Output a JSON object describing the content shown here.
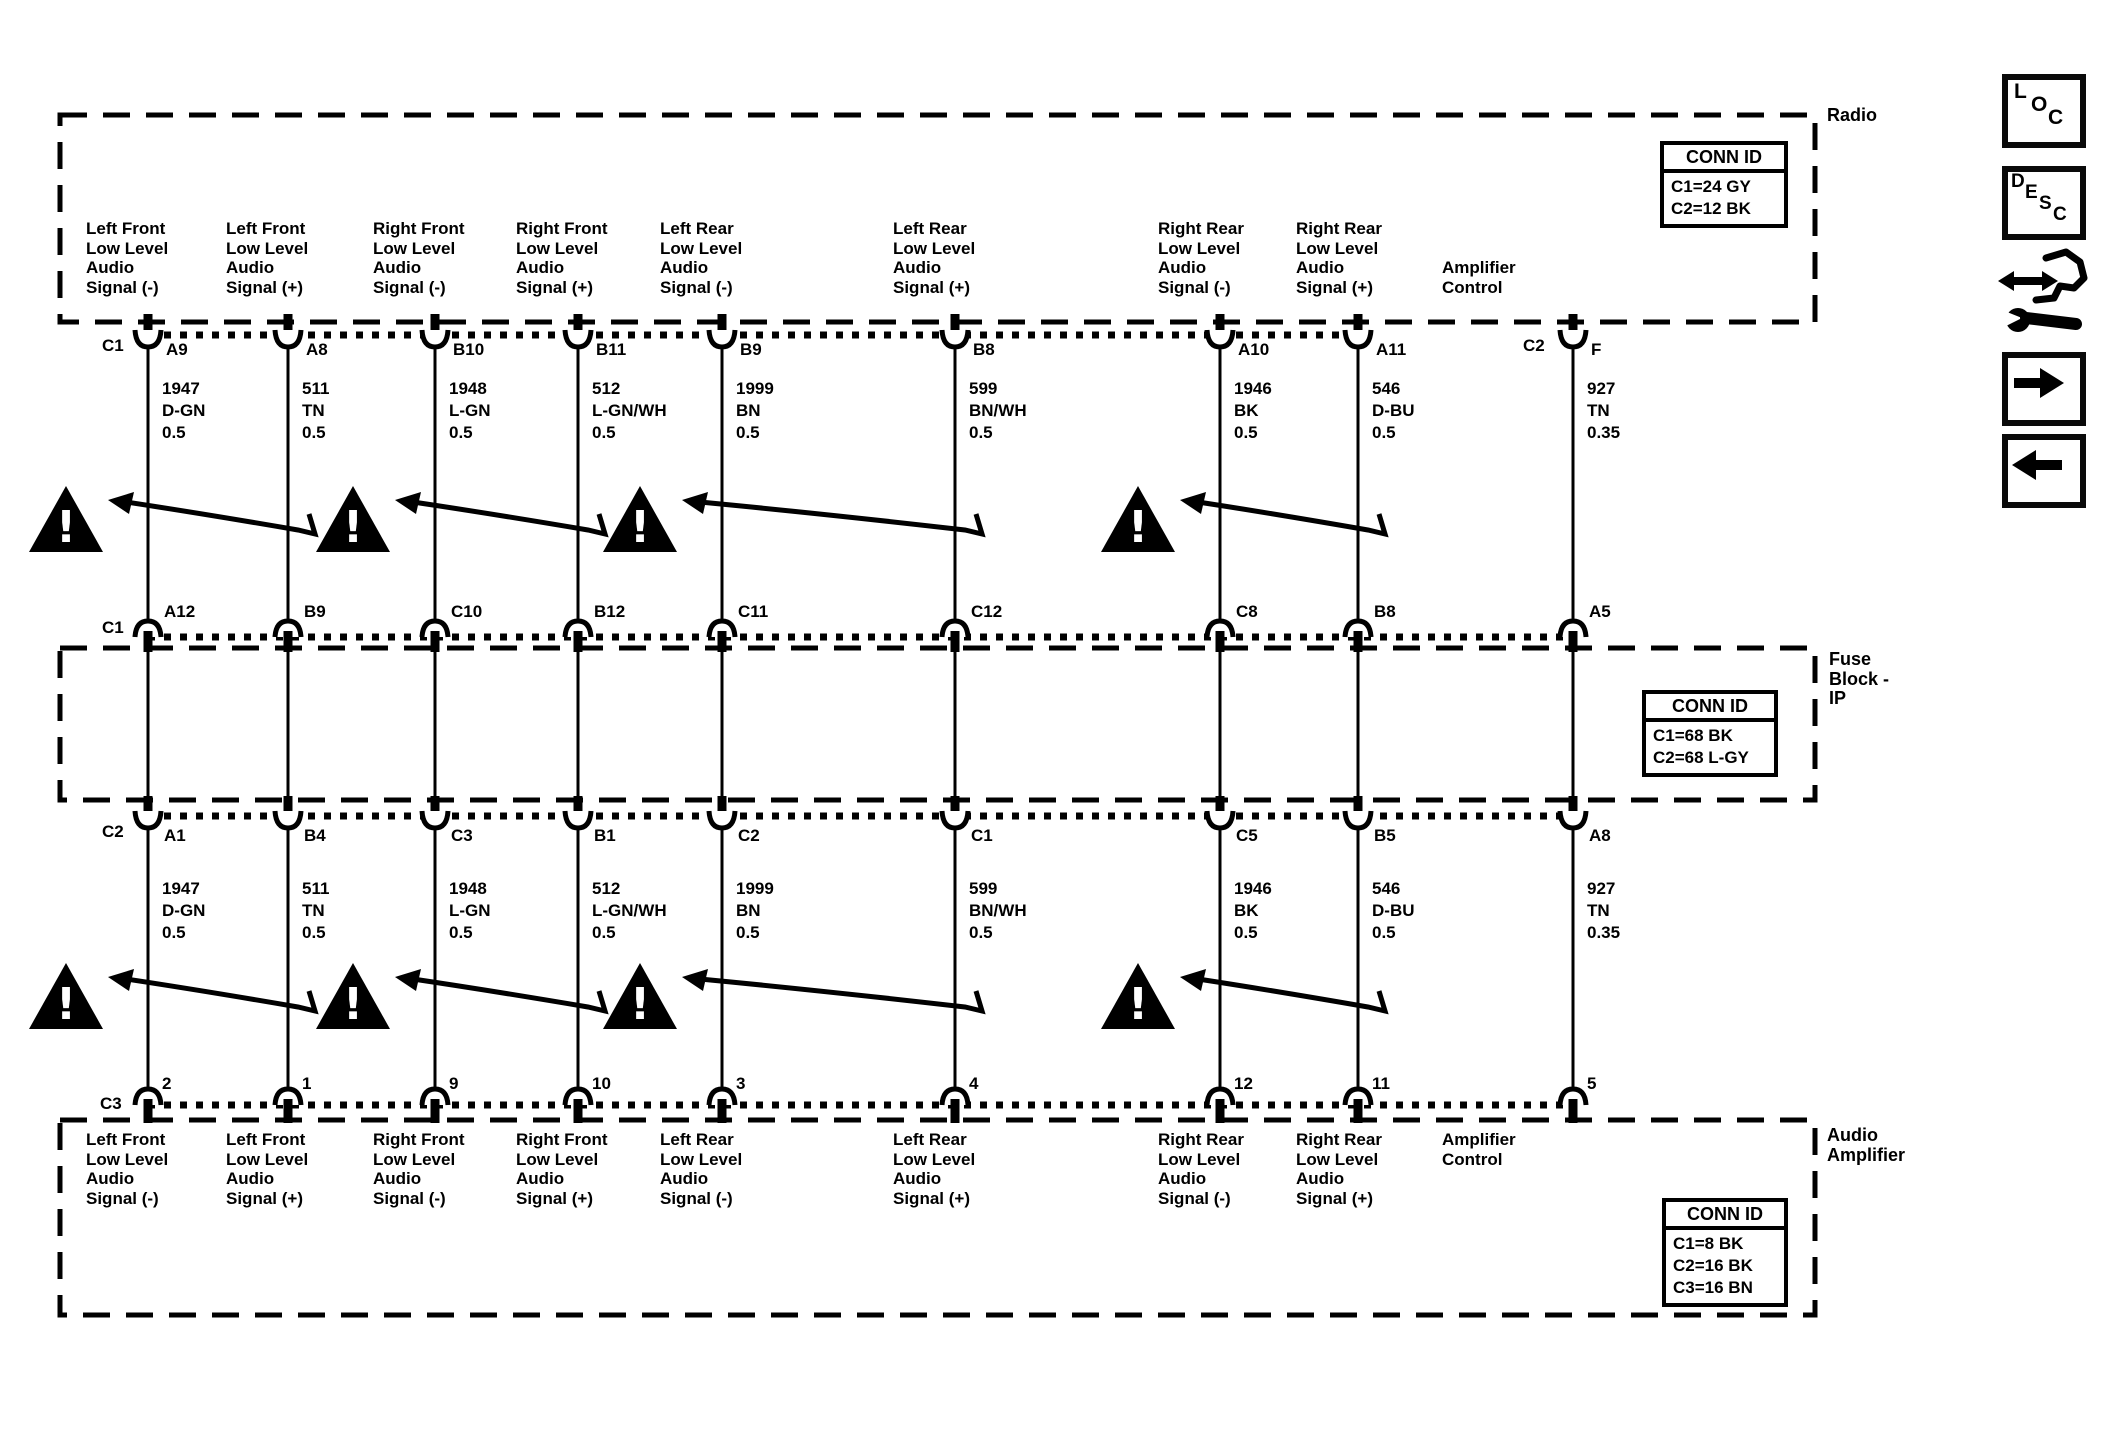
{
  "diagram": {
    "boxes": {
      "radio": {
        "title": "Radio",
        "conn_id": {
          "header": "CONN ID",
          "rows": [
            "C1=24 GY",
            "C2=12 BK"
          ]
        }
      },
      "fuse_block": {
        "title_lines": [
          "Fuse",
          "Block -",
          "IP"
        ],
        "conn_id": {
          "header": "CONN ID",
          "rows": [
            "C1=68 BK",
            "C2=68 L-GY"
          ]
        }
      },
      "audio_amplifier": {
        "title_lines": [
          "Audio",
          "Amplifier"
        ],
        "conn_id": {
          "header": "CONN ID",
          "rows": [
            "C1=8 BK",
            "C2=16 BK",
            "C3=16 BN"
          ]
        }
      }
    },
    "connector_designators": {
      "radio_c1": "C1",
      "radio_c2": "C2",
      "fuse_top": "C1",
      "fuse_bottom": "C2",
      "amp": "C3"
    },
    "columns": [
      {
        "signal": [
          "Left Front",
          "Low Level",
          "Audio",
          "Signal (-)"
        ],
        "radio_pin": "A9",
        "circuit": "1947",
        "color": "D-GN",
        "gauge": "0.5",
        "fuse_top_pin": "A12",
        "fuse_bottom_pin": "A1",
        "amp_pin": "2"
      },
      {
        "signal": [
          "Left Front",
          "Low Level",
          "Audio",
          "Signal (+)"
        ],
        "radio_pin": "A8",
        "circuit": "511",
        "color": "TN",
        "gauge": "0.5",
        "fuse_top_pin": "B9",
        "fuse_bottom_pin": "B4",
        "amp_pin": "1"
      },
      {
        "signal": [
          "Right Front",
          "Low Level",
          "Audio",
          "Signal (-)"
        ],
        "radio_pin": "B10",
        "circuit": "1948",
        "color": "L-GN",
        "gauge": "0.5",
        "fuse_top_pin": "C10",
        "fuse_bottom_pin": "C3",
        "amp_pin": "9"
      },
      {
        "signal": [
          "Right Front",
          "Low Level",
          "Audio",
          "Signal (+)"
        ],
        "radio_pin": "B11",
        "circuit": "512",
        "color": "L-GN/WH",
        "gauge": "0.5",
        "fuse_top_pin": "B12",
        "fuse_bottom_pin": "B1",
        "amp_pin": "10"
      },
      {
        "signal": [
          "Left Rear",
          "Low Level",
          "Audio",
          "Signal (-)"
        ],
        "radio_pin": "B9",
        "circuit": "1999",
        "color": "BN",
        "gauge": "0.5",
        "fuse_top_pin": "C11",
        "fuse_bottom_pin": "C2",
        "amp_pin": "3"
      },
      {
        "signal": [
          "Left Rear",
          "Low Level",
          "Audio",
          "Signal (+)"
        ],
        "radio_pin": "B8",
        "circuit": "599",
        "color": "BN/WH",
        "gauge": "0.5",
        "fuse_top_pin": "C12",
        "fuse_bottom_pin": "C1",
        "amp_pin": "4"
      },
      {
        "signal": [
          "Right Rear",
          "Low Level",
          "Audio",
          "Signal (-)"
        ],
        "radio_pin": "A10",
        "circuit": "1946",
        "color": "BK",
        "gauge": "0.5",
        "fuse_top_pin": "C8",
        "fuse_bottom_pin": "C5",
        "amp_pin": "12"
      },
      {
        "signal": [
          "Right Rear",
          "Low Level",
          "Audio",
          "Signal (+)"
        ],
        "radio_pin": "A11",
        "circuit": "546",
        "color": "D-BU",
        "gauge": "0.5",
        "fuse_top_pin": "B8",
        "fuse_bottom_pin": "B5",
        "amp_pin": "11"
      },
      {
        "signal": [
          "Amplifier",
          "Control"
        ],
        "radio_pin": "F",
        "circuit": "927",
        "color": "TN",
        "gauge": "0.35",
        "fuse_top_pin": "A5",
        "fuse_bottom_pin": "A8",
        "amp_pin": "5"
      }
    ],
    "twisted_pairs": [
      [
        0,
        1
      ],
      [
        2,
        3
      ],
      [
        4,
        5
      ],
      [
        6,
        7
      ]
    ],
    "warning_symbol": "!",
    "line_color": "#000000"
  },
  "side_toolbar": {
    "loc_letters": [
      "L",
      "O",
      "C"
    ],
    "desc_letters": [
      "D",
      "E",
      "S",
      "C"
    ]
  }
}
